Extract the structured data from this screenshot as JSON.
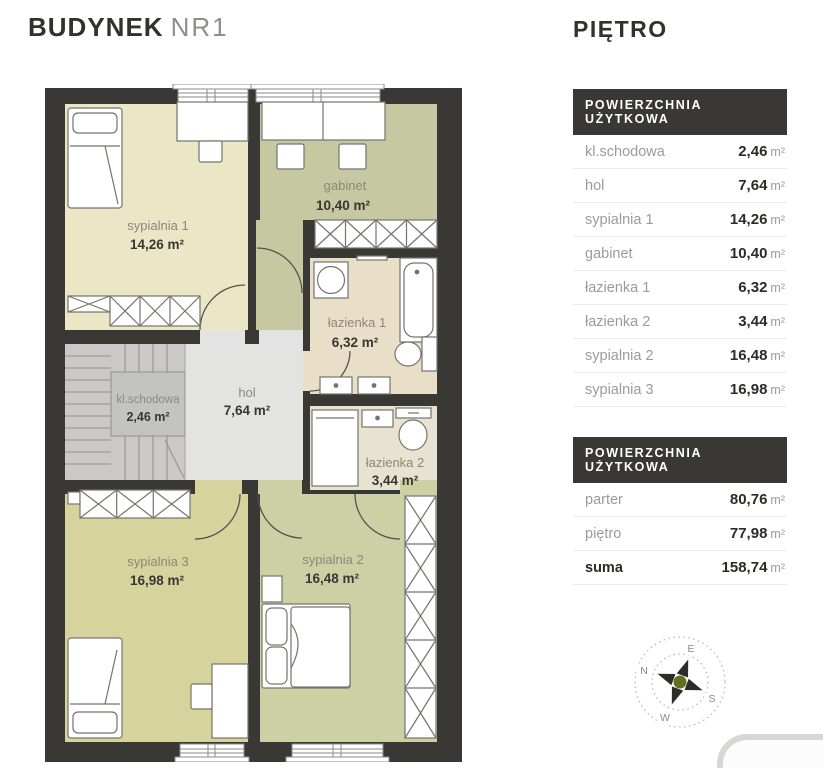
{
  "page": {
    "title_bold": "BUDYNEK",
    "title_light": "NR1",
    "floor_heading": "PIĘTRO"
  },
  "tables": [
    {
      "header": "POWIERZCHNIA UŻYTKOWA",
      "rows": [
        {
          "label": "kl.schodowa",
          "value": "2,46",
          "unit": "m²"
        },
        {
          "label": "hol",
          "value": "7,64",
          "unit": "m²"
        },
        {
          "label": "sypialnia 1",
          "value": "14,26",
          "unit": "m²"
        },
        {
          "label": "gabinet",
          "value": "10,40",
          "unit": "m²"
        },
        {
          "label": "łazienka 1",
          "value": "6,32",
          "unit": "m²"
        },
        {
          "label": "łazienka 2",
          "value": "3,44",
          "unit": "m²"
        },
        {
          "label": "sypialnia 2",
          "value": "16,48",
          "unit": "m²"
        },
        {
          "label": "sypialnia 3",
          "value": "16,98",
          "unit": "m²"
        }
      ]
    },
    {
      "header": "POWIERZCHNIA UŻYTKOWA",
      "rows": [
        {
          "label": "parter",
          "value": "80,76",
          "unit": "m²"
        },
        {
          "label": "piętro",
          "value": "77,98",
          "unit": "m²"
        },
        {
          "label": "suma",
          "value": "158,74",
          "unit": "m²"
        }
      ]
    }
  ],
  "plan": {
    "rooms": [
      {
        "name": "sypialnia 1",
        "area": "14,26 m²"
      },
      {
        "name": "gabinet",
        "area": "10,40 m²"
      },
      {
        "name": "łazienka 1",
        "area": "6,32 m²"
      },
      {
        "name": "kl.schodowa",
        "area": "2,46 m²"
      },
      {
        "name": "hol",
        "area": "7,64 m²"
      },
      {
        "name": "łazienka 2",
        "area": "3,44 m²"
      },
      {
        "name": "sypialnia 3",
        "area": "16,98 m²"
      },
      {
        "name": "sypialnia 2",
        "area": "16,48 m²"
      }
    ]
  },
  "compass": {
    "n": "N",
    "e": "E",
    "s": "S",
    "w": "W"
  },
  "colors": {
    "wall": "#3a3834",
    "room_cream": "#eae6c6",
    "room_olive": "#c6c8a2",
    "room_tan": "#e9dfc9",
    "room_pale": "#e8e3d1",
    "room_yellowgreen": "#d6d49c",
    "room_green": "#cbd1a5",
    "hall_gray": "#e3e3e1",
    "stairs_gray": "#cac9c7",
    "accent_green": "#62701f"
  }
}
